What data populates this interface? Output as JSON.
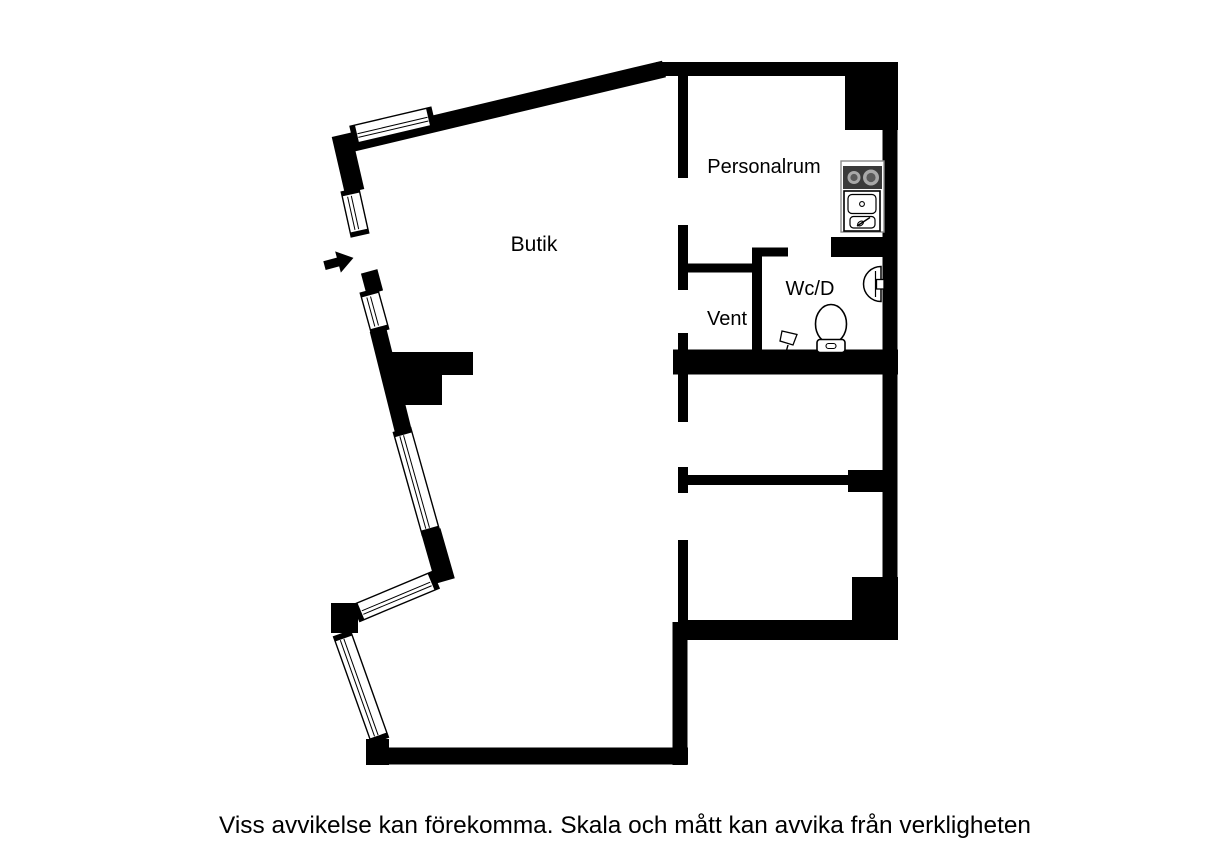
{
  "caption": "Viss avvikelse kan förekomma. Skala och mått kan avvika från verkligheten",
  "rooms": {
    "butik": {
      "label": "Butik"
    },
    "personalrum": {
      "label": "Personalrum"
    },
    "wcd": {
      "label": "Wc/D"
    },
    "vent": {
      "label": "Vent"
    }
  },
  "symbols": {
    "entrance_arrow": "entrance-arrow",
    "window": "window-symbol",
    "stove": "stove-symbol",
    "sink": "sink-symbol",
    "washbasin": "washbasin-symbol",
    "toilet": "toilet-symbol",
    "floor_drain": "floor-drain-symbol"
  },
  "colors": {
    "background": "#ffffff",
    "walls": "#000000",
    "text": "#000000",
    "fixture_outline": "#000000",
    "counter_outline": "#8a8a8a",
    "stove_body": "#3a3a3a",
    "burner_ring": "#a8a8a8",
    "burner_center": "#5a5a5a"
  }
}
